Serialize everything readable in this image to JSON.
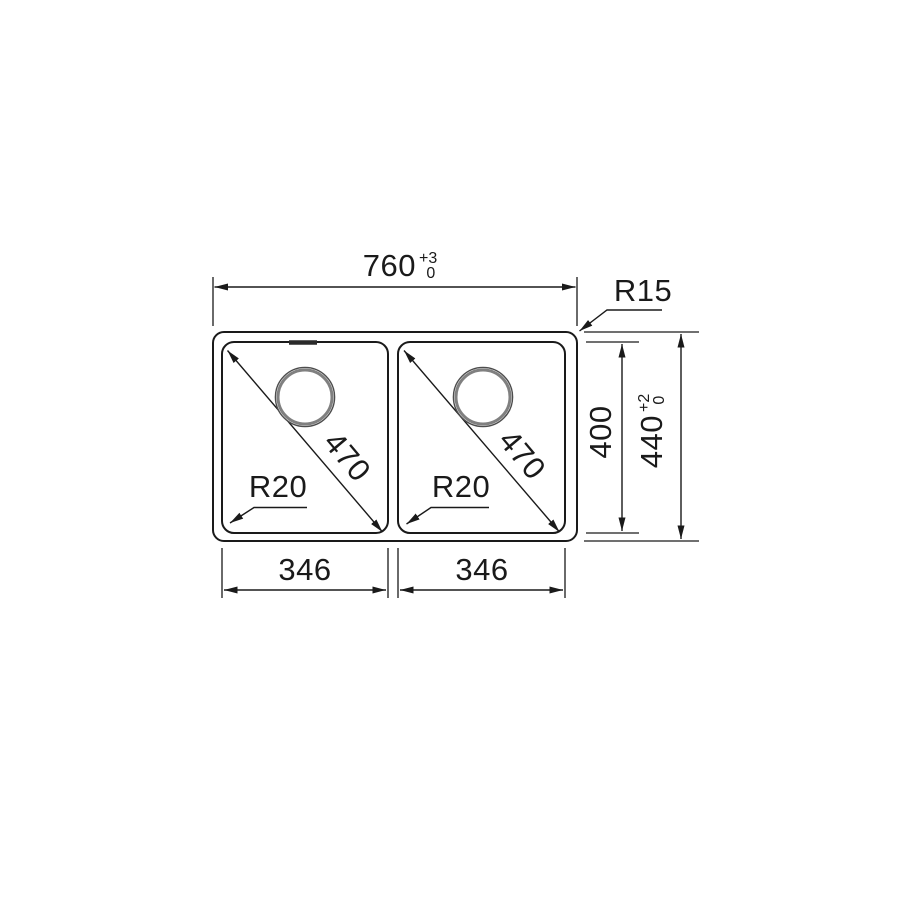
{
  "colors": {
    "background": "#ffffff",
    "line": "#1a1a1a",
    "drain_ring": "#808080"
  },
  "dimensions": {
    "overall_width": {
      "value": "760",
      "tol_upper": "+3",
      "tol_lower": "0"
    },
    "overall_depth": {
      "value": "440",
      "tol_upper": "+2",
      "tol_lower": "0"
    },
    "bowl_depth": {
      "value": "400"
    },
    "bowl_width_left": "346",
    "bowl_width_right": "346",
    "bowl_diagonal_left": "470",
    "bowl_diagonal_right": "470",
    "outer_corner_radius": "R15",
    "bowl_corner_radius_left": "R20",
    "bowl_corner_radius_right": "R20"
  }
}
